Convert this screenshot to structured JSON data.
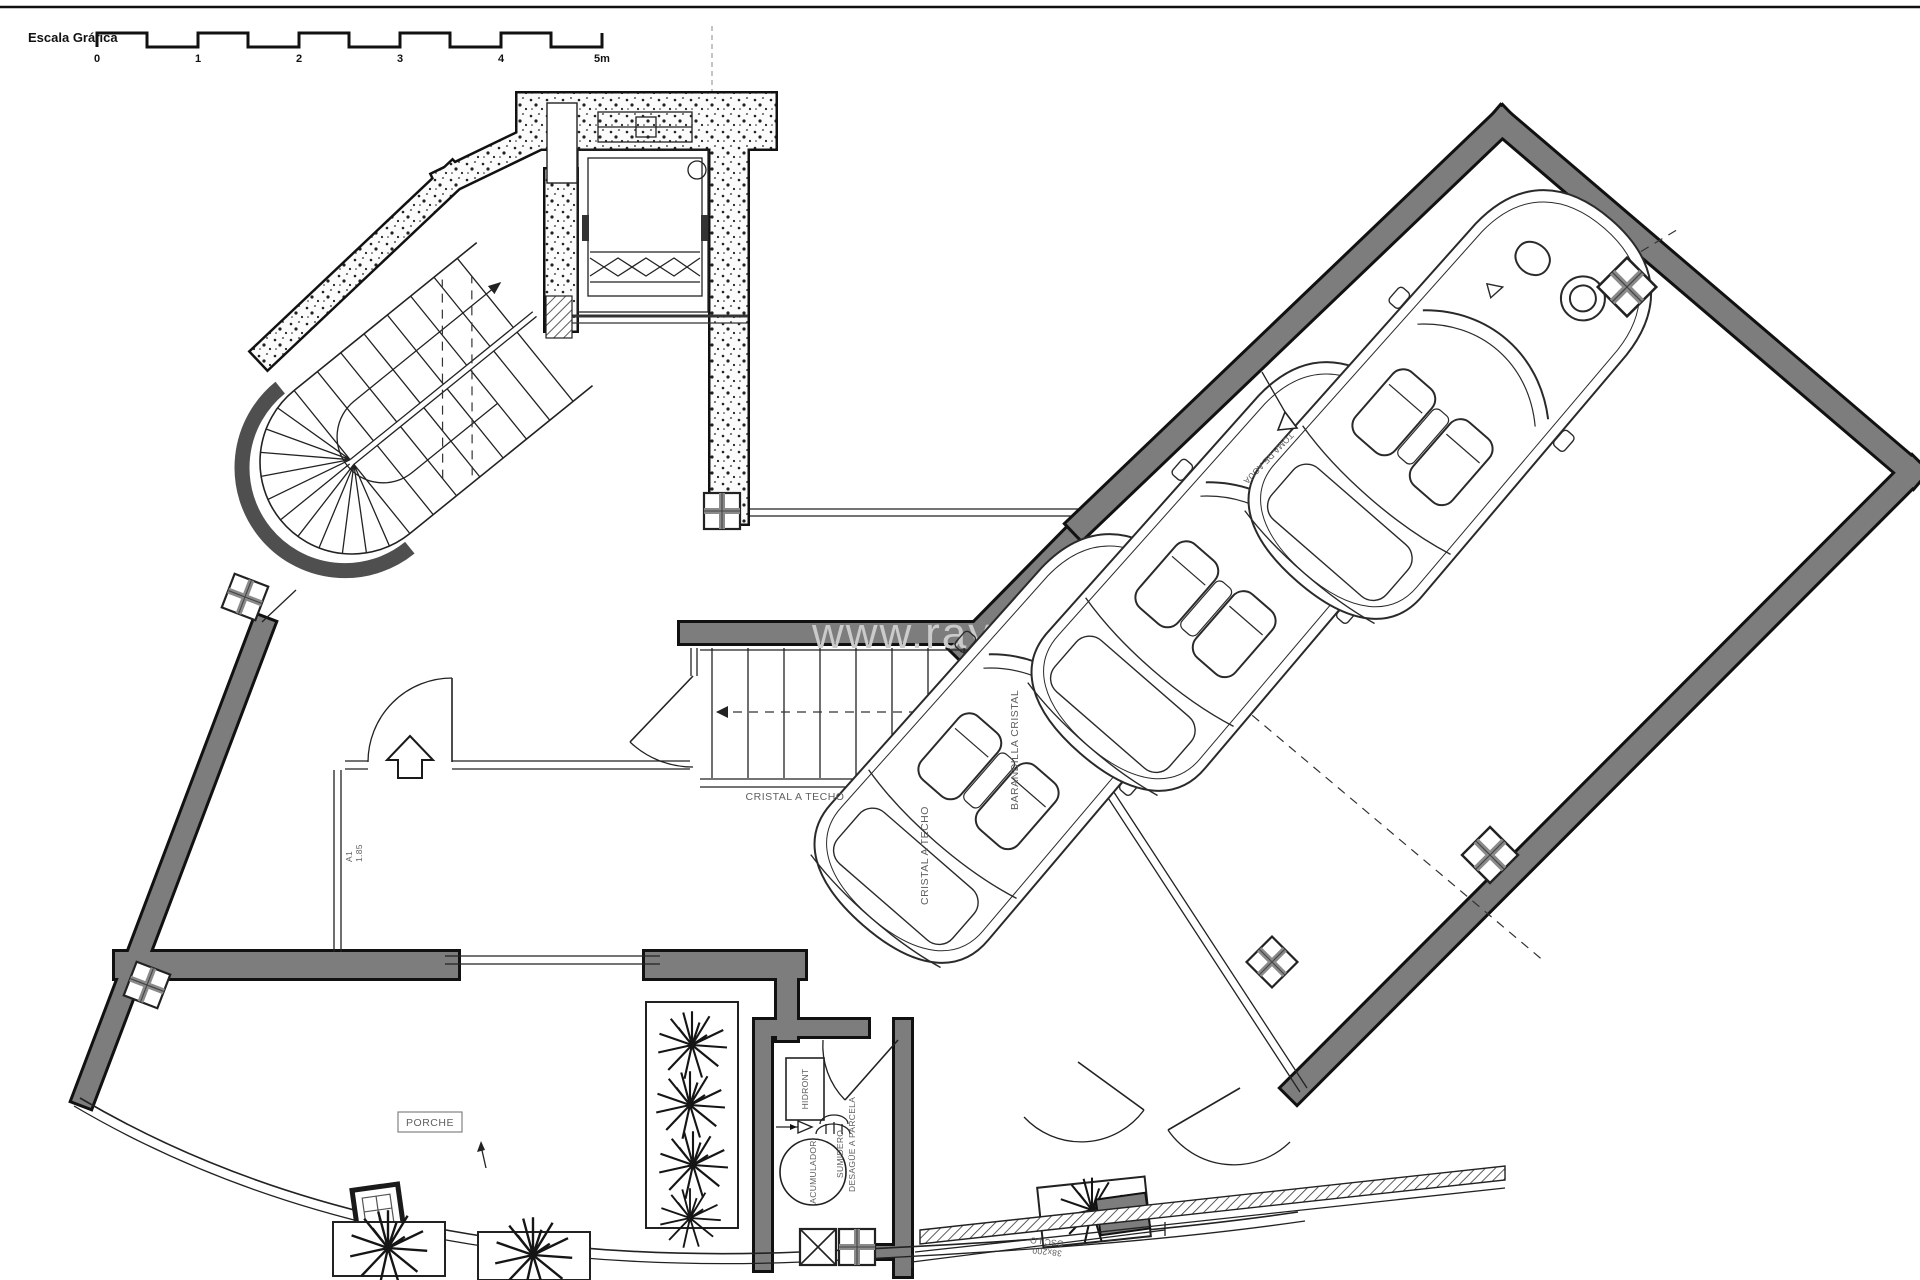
{
  "scale_bar": {
    "label": "Escala Gráfica",
    "ticks": [
      "0",
      "1",
      "2",
      "3",
      "4",
      "5m"
    ]
  },
  "watermark": {
    "text": "www.rayosde"
  },
  "stairs": {
    "glass_to_ceiling": "CRISTAL A TECHO",
    "glass_to_ceiling_vertical": "CRISTAL A TECHO",
    "glass_railing": "BARANDILLA CRISTAL"
  },
  "garage": {
    "water_intake": "TOMA DE AGUA"
  },
  "porch": {
    "label": "PORCHE"
  },
  "entry": {
    "door_code": "A1",
    "door_width": "1.85"
  },
  "utility": {
    "hydro_unit": "HIDRONT",
    "accumulator": "ACUMULADOR",
    "drain": "SUMIDERO",
    "drain_to_plot": "DESAGÜE A PARCELA"
  },
  "channel": {
    "dim": "38x200",
    "note": "OSCILO"
  },
  "colors": {
    "wall": "#7d7d7d",
    "line": "#1c1c1c",
    "label": "#5f5f5f",
    "watermark": "#cbcbcb"
  }
}
